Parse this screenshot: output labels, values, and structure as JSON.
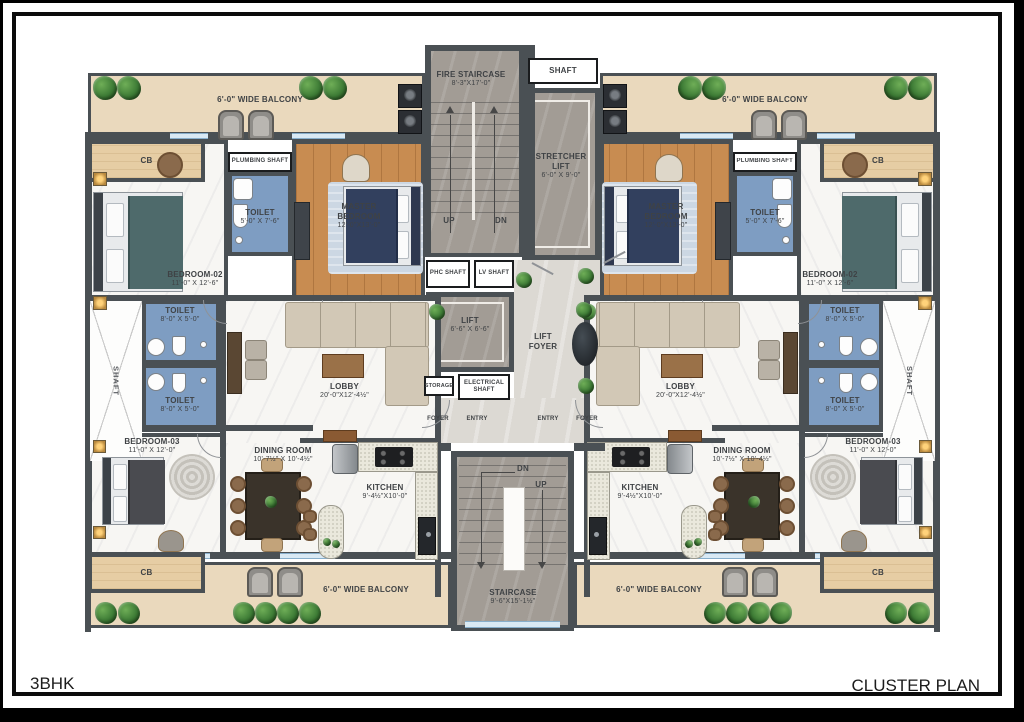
{
  "title_block": {
    "left": "3BHK",
    "right": "CLUSTER PLAN"
  },
  "core": {
    "fire_staircase_name": "FIRE STAIRCASE",
    "fire_staircase_dim": "8'-3\"X17'-0\"",
    "shaft_top": "SHAFT",
    "stretcher_1": "STRETCHER",
    "stretcher_2": "LIFT",
    "stretcher_dim": "6'-0\" X 9'-0\"",
    "up": "UP",
    "dn": "DN",
    "phc_shaft": "PHC SHAFT",
    "lv_shaft": "LV SHAFT",
    "lift_name": "LIFT",
    "lift_dim": "6'-6\" X 6'-6\"",
    "lift_foyer_1": "LIFT",
    "lift_foyer_2": "FOYER",
    "storage": "STORAGE",
    "electrical_1": "ELECTRICAL",
    "electrical_2": "SHAFT",
    "foyer": "FOYER",
    "entry": "ENTRY",
    "staircase_name": "STAIRCASE",
    "staircase_dim": "9'-6\"X15'-1½\""
  },
  "unit": {
    "balcony_top": "6'-0\" WIDE BALCONY",
    "balcony_bottom": "6'-0\" WIDE BALCONY",
    "cb": "CB",
    "bedroom2_name": "BEDROOM-02",
    "bedroom2_dim": "11'-0\" X 12'-6\"",
    "toilet_small_name": "TOILET",
    "toilet_small_dim": "5'-0\" X 7'-6\"",
    "plumbing_shaft": "PLUMBING SHAFT",
    "master_name": "MASTER BEDROOM",
    "master_dim": "12'-0\"X13'-0\"",
    "shaft": "SHAFT",
    "toilet_a_name": "TOILET",
    "toilet_a_dim": "8'-0\" X 5'-0\"",
    "toilet_b_name": "TOILET",
    "toilet_b_dim": "8'-0\" X 5'-0\"",
    "lobby_name": "LOBBY",
    "lobby_dim": "20'-0\"X12'-4½\"",
    "bedroom3_name": "BEDROOM-03",
    "bedroom3_dim": "11'-0\" X 12'-0\"",
    "dining_name": "DINING ROOM",
    "dining_dim": "10'-7½\" X 10'-4½\"",
    "kitchen_name": "KITCHEN",
    "kitchen_dim": "9'-4½\"X10'-0\""
  },
  "colors": {
    "wall": "#4a5054",
    "wood_floor": "#c88c51",
    "toilet_tile": "#7e9dc2",
    "balcony_floor": "#ead9bd",
    "stair_floor": "#a29c95",
    "marble_floor": "#f7f6f3"
  }
}
